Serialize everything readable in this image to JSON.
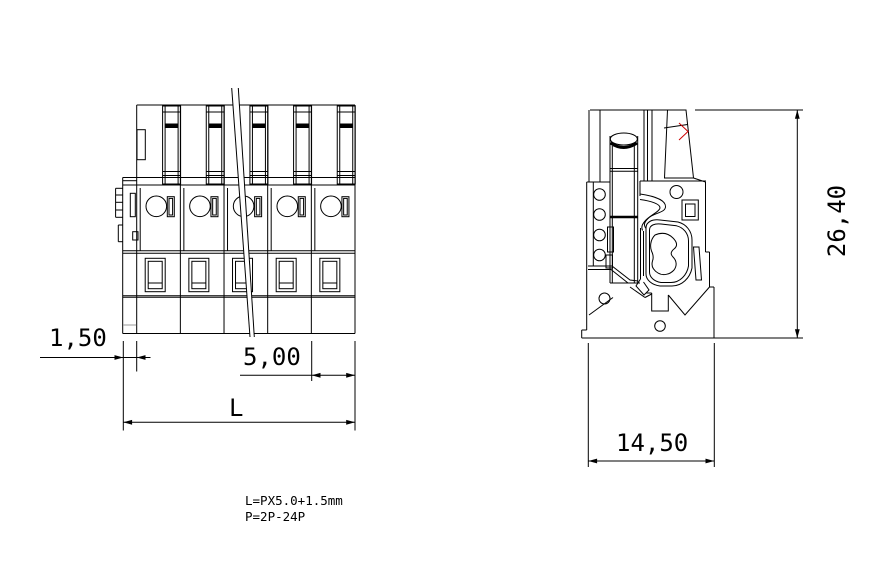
{
  "drawing": {
    "type": "terminal-block-technical-drawing",
    "dim_labels": {
      "offset": "1,50",
      "pitch": "5,00",
      "length": "L",
      "height": "26,40",
      "depth": "14,50"
    },
    "notes": {
      "line1": "L=PX5.0+1.5mm",
      "line2": "P=2P-24P"
    },
    "colors": {
      "line": "#000000",
      "highlight": "#cc0000",
      "muted": "#9a9a9a",
      "background": "#ffffff"
    }
  }
}
